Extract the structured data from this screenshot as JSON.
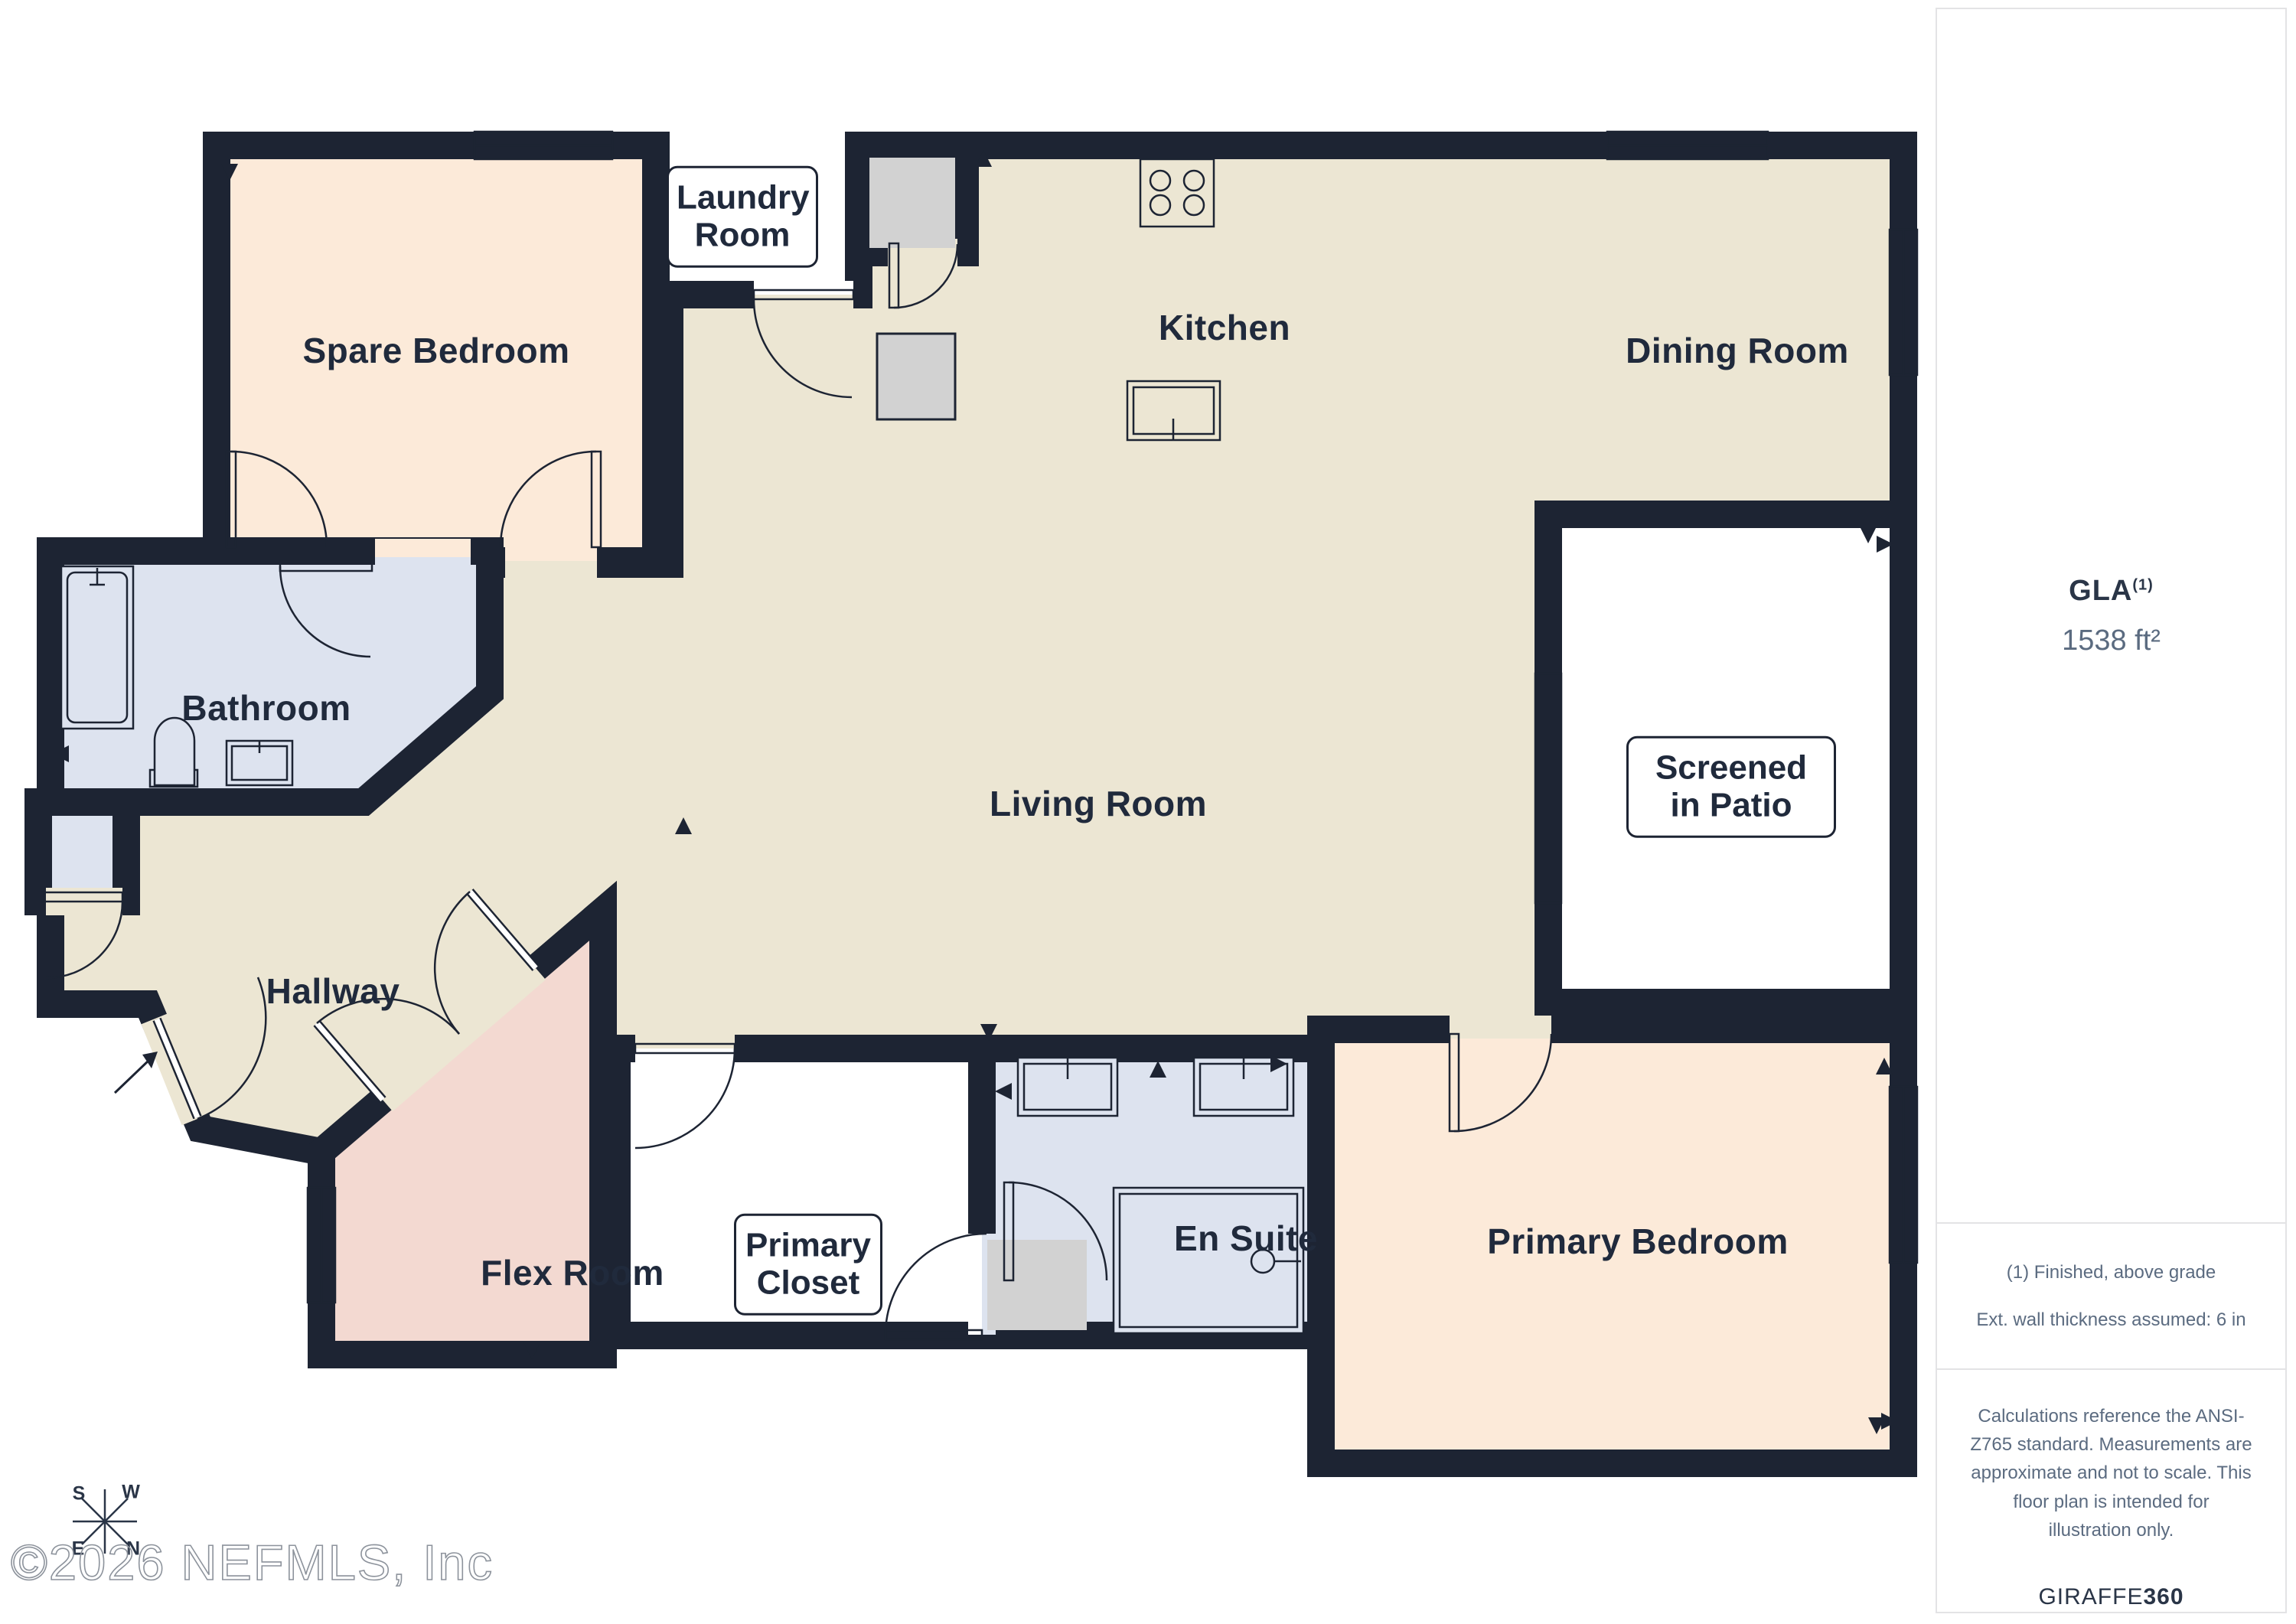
{
  "plan": {
    "rooms": [
      {
        "id": "spare-bedroom",
        "label": "Spare Bedroom"
      },
      {
        "id": "kitchen",
        "label": "Kitchen"
      },
      {
        "id": "dining-room",
        "label": "Dining Room"
      },
      {
        "id": "bathroom",
        "label": "Bathroom"
      },
      {
        "id": "living-room",
        "label": "Living Room"
      },
      {
        "id": "hallway",
        "label": "Hallway"
      },
      {
        "id": "flex-room",
        "label": "Flex Room"
      },
      {
        "id": "en-suite",
        "label": "En Suite"
      },
      {
        "id": "primary-bedroom",
        "label": "Primary Bedroom"
      }
    ],
    "boxed_labels": [
      {
        "id": "laundry-room",
        "label": "Laundry Room"
      },
      {
        "id": "screened-in-patio",
        "label": "Screened in Patio"
      },
      {
        "id": "primary-closet",
        "label": "Primary Closet"
      }
    ],
    "compass": {
      "n": "N",
      "s": "S",
      "e": "E",
      "w": "W"
    }
  },
  "sidebar": {
    "gla_label": "GLA",
    "gla_note_ref": "(1)",
    "gla_value": "1538 ft²",
    "notes": [
      "(1) Finished, above grade",
      "Ext. wall thickness assumed: 6 in"
    ],
    "disclaimer": "Calculations reference the ANSI-Z765 standard. Measurements are approximate and not to scale. This floor plan is intended for illustration only.",
    "brand": {
      "name": "GIRAFFE",
      "suffix": "360"
    }
  },
  "watermark": "©2026 NEFMLS, Inc",
  "colors": {
    "wall": "#1d2433",
    "floor": "#ece6d3",
    "bedroom": "#fcead9",
    "bath": "#dde3ef",
    "flex": "#f3d9d1",
    "fixture": "#d2d2d2",
    "patio": "#ffffff",
    "text": "#202a3c",
    "muted": "#5b6b80",
    "border": "#e3e3e5"
  }
}
